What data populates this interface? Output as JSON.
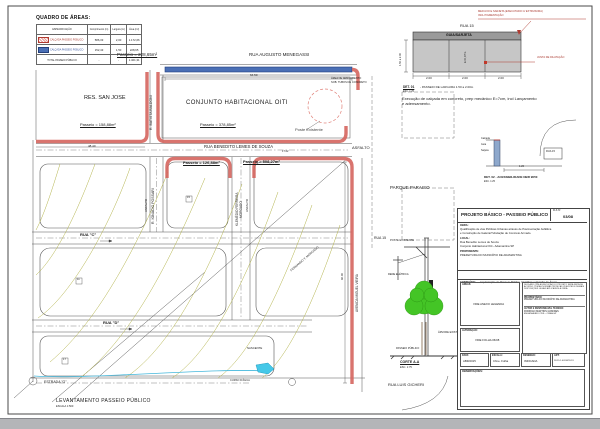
{
  "quadro": {
    "title": "QUADRO DE ÁREAS:",
    "headers": {
      "spec": "ESPECIFICAÇÃO",
      "comp": "Comprimento (m)",
      "larg": "Largura (m)",
      "area": "Área (m²)"
    },
    "rows": [
      {
        "spec": "CALÇADA PASSEIO PÚBLICO",
        "comp": "586,33",
        "larg": "2,00",
        "area": "1.172,66"
      },
      {
        "spec": "CALÇADA PASSEIO PÚBLICO",
        "comp": "152,43",
        "larg": "1,50",
        "area": "228,65"
      },
      {
        "spec": "TOTAL PASSEIO PÚBLICO",
        "comp": "-",
        "larg": "-",
        "area": "1.401,31"
      }
    ]
  },
  "plan": {
    "rua_augusto": "RUA AUGUSTO MENEGASSI",
    "passeio_azul": "Passeio = 228,65m²",
    "dim_top": "64.50",
    "arruamento": "ÁREA DE ARRUAMENTO",
    "tubos": "SOB. TUBOS DE CONCRETO",
    "conjunto": "CONJUNTO HABITACIONAL OITI",
    "res_san_jose": "RES. SAN JOSE",
    "passeio_sanjose": "Passeio = 158,88m²",
    "dim_sanjose": "48.40",
    "poste": "Poste Existente",
    "passeio_norte": "Passeio = 378,85m²",
    "rua_benedito": "RUA BENEDITO LEMES DE SOUZA",
    "dim_benedito": "17.02",
    "asfalto": "ASFALTO",
    "passeio_sul": "Passeio = 508,27m²",
    "passeio_centro": "Passeio = 126,88m²",
    "r_batista": "R. BATISTA BALDONI",
    "r_ignacio": "R. IGNÁCIO POSSARI",
    "klemedio1": "KLEMÉDIO FERREIRA",
    "klemedio2": "MORGADO",
    "parque": "PARQUE PARAISO",
    "rua15": "RUA 15",
    "avenida": "AVENIDA MIGUEL VIEIRA",
    "dim_avenida": "96.00",
    "rua_c": "RUA \"C\"",
    "rua_d": "RUA \"D\"",
    "estrada": "ESTRADA \"G\"",
    "fernando": "FERNANDO T. MORGADO",
    "nascente": "NASCENTE",
    "curso": "CURSO D'ÁGUA",
    "rua_luis": "RUA LUIS GICHERI",
    "lote1": "15",
    "lote2": "11",
    "lote3": "17"
  },
  "corte": {
    "title": "CORTE A-A",
    "esc": "ESC. 1:75",
    "poste": "POSTE EXISTENTE",
    "rede": "REDE ELÉTRICA",
    "arvore": "ÁRVORE EXISTENTE",
    "passeio": "PASSEIO PÚBLICO"
  },
  "det01": {
    "rua": "RUA 15",
    "guia": "GUIA/SARJETA",
    "nota1a": "MEIO-FIO E SARJETA (EXECUTADO C/ EXTRUSORA)",
    "nota1b": "INCL PIGMENTAÇÃO",
    "junta": "JUNTA DE DILATAÇÃO",
    "esp": "E=0,07m",
    "larg": "1.50 a 2.00",
    "d1": "2.00",
    "d2": "2.00",
    "d3": "2.00",
    "titulo": "DET. 01",
    "titulo2": "- PASSEIO DE LARGURA 1.50 a 2.00m",
    "esc": "ESC. 1:25",
    "nota2a": "Execução de calçada em concreto, prep mecânico E=7cm, incl Lançamento",
    "nota2b": "e adensamento."
  },
  "det02": {
    "l1": "Calçada",
    "l2": "Guia",
    "l3": "Sarjeta",
    "rua": "RUA 15",
    "dim": "1.20",
    "titulo": "DET. 02 - ACESSIBILIDADE NBR 9050",
    "esc": "ESC. 1:25"
  },
  "footer": {
    "titulo": "LEVANTAMENTO  PASSEIO PÚBLICO",
    "esc": "ESCALA  1:500"
  },
  "titleblock": {
    "titulo": "PROJETO BÁSICO  -  PASSEIO PÚBLICO",
    "fls_label": "FLS Nº",
    "fls": "03/08",
    "obra_label": "OBRA:",
    "obra1": "Qualificação de vias Públicas Urbanas através de Pavimentação Asfáltica",
    "obra2": "e Construção de Galeria/Tubulação de Concreto Armado.",
    "local_label": "LOCAL:",
    "local1": "Rua Benedito Lemes de Souza",
    "local2": "Conjunto Habitacional Oiti - Adamantina SP",
    "prop_label": "PROPONENTE:",
    "prop": "PREFEITURA DO MUNICÍPIO DE ADAMANTINA",
    "cont_label": "CONTEÚDO:",
    "cont": "Implantação do Passeio Público, Detalhes e Quadro de Áreas",
    "areas_label": "ÁREAS:",
    "areas": "VIDE ANEXO LEGENDA",
    "alt_label": "ALTERAÇÃO:",
    "alt": "VIDE FOLHA 06/08",
    "decl": "DECLARO QUE A EXECUÇÃO DO PROJETO SERÁ FEITA DE ACORDO COM AS NORMAS TÉCNICAS VIGENTES E DEMAIS DISPOSIÇÕES LEGAIS APLICÁVEIS À OBRA.",
    "proprietario_label": "PROPRIETÁRIO:",
    "proprietario": "PREFEITURA DO MUNICÍPIO DE ADAMANTINA",
    "autor_label": "AUTOR E RESPONSÁVEL TÉCNICO:",
    "autor1": "RODRIGO MARTINS GOMIDES",
    "autor2": "ENGENHEIRO CIVIL - CREA-SP",
    "data_label": "DATA:",
    "data": "ABR/2015",
    "escala_label": "ESCALA:",
    "escala": "Cfme. Folha",
    "desenho_label": "DESENHO:",
    "desenho": "INDICADA",
    "art_label": "ART:",
    "art": "28.15.1.0013678-19",
    "obs_label": "OBSERVAÇÕES:"
  }
}
